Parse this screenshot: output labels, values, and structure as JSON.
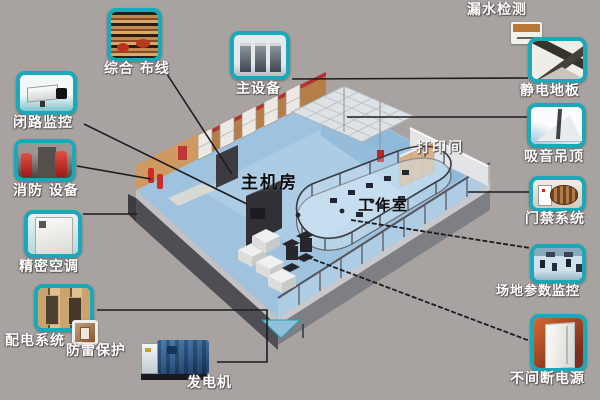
{
  "colors": {
    "background": "#a8a3a1",
    "accent_teal": "#1aa9b8",
    "floor_blue": "#9fc2de",
    "connector": "#1c1c1e"
  },
  "room_labels": {
    "main_room": "主机房",
    "work_room": "工作室",
    "print_room": "打印间"
  },
  "callouts": {
    "cabling": {
      "label": "综合 布线"
    },
    "cctv": {
      "label": "闭路监控"
    },
    "fire_equipment": {
      "label": "消防 设备"
    },
    "precision_ac": {
      "label": "精密空调"
    },
    "power_distribution": {
      "label": "配电系统"
    },
    "lightning_protection": {
      "label": "防雷保护"
    },
    "generator": {
      "label": "发电机"
    },
    "main_equipment": {
      "label": "主设备"
    },
    "leak_detection": {
      "label": "漏水检测"
    },
    "antistatic_floor": {
      "label": "静电地板"
    },
    "acoustic_ceiling": {
      "label": "吸音吊顶"
    },
    "access_control": {
      "label": "门禁系统"
    },
    "site_monitoring": {
      "label": "场地参数监控"
    },
    "ups": {
      "label": "不间断电源"
    }
  }
}
